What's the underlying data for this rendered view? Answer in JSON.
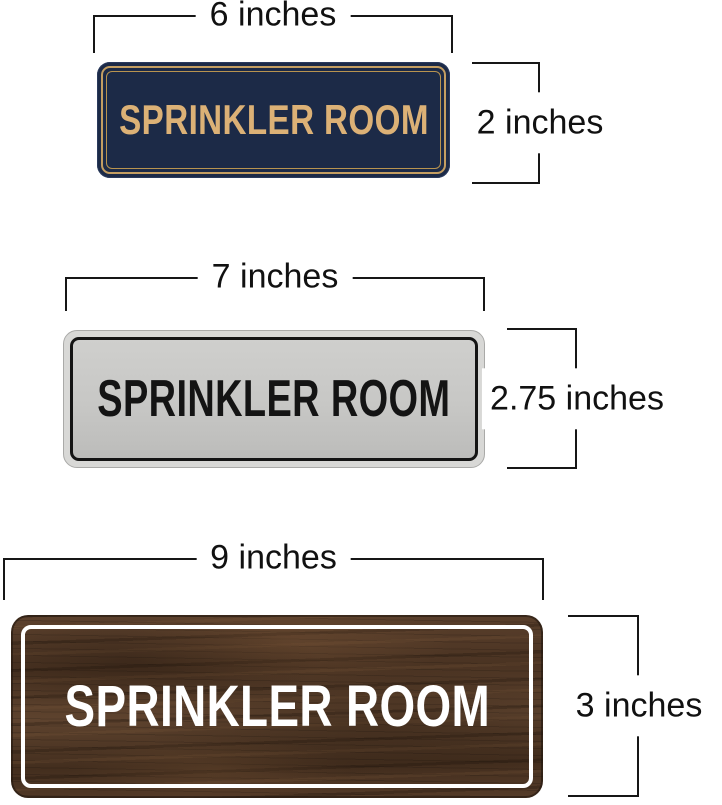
{
  "signs": [
    {
      "name": "navy-gold-sign",
      "label": "SPRINKLER ROOM",
      "width_label": "6 inches",
      "height_label": "2 inches",
      "colors": {
        "background": "#1c2a47",
        "border": "#c49e62",
        "text": "#dcb176"
      }
    },
    {
      "name": "silver-black-sign",
      "label": "SPRINKLER ROOM",
      "width_label": "7 inches",
      "height_label": "2.75 inches",
      "colors": {
        "frame": "#d8d8d6",
        "field": "#c7c7c5",
        "border": "#141414",
        "text": "#141414"
      }
    },
    {
      "name": "walnut-wood-sign",
      "label": "SPRINKLER ROOM",
      "width_label": "9 inches",
      "height_label": "3 inches",
      "colors": {
        "wood": "#523a28",
        "border": "#ffffff",
        "text": "#ffffff"
      }
    }
  ],
  "dimension_line_color": "#161616"
}
